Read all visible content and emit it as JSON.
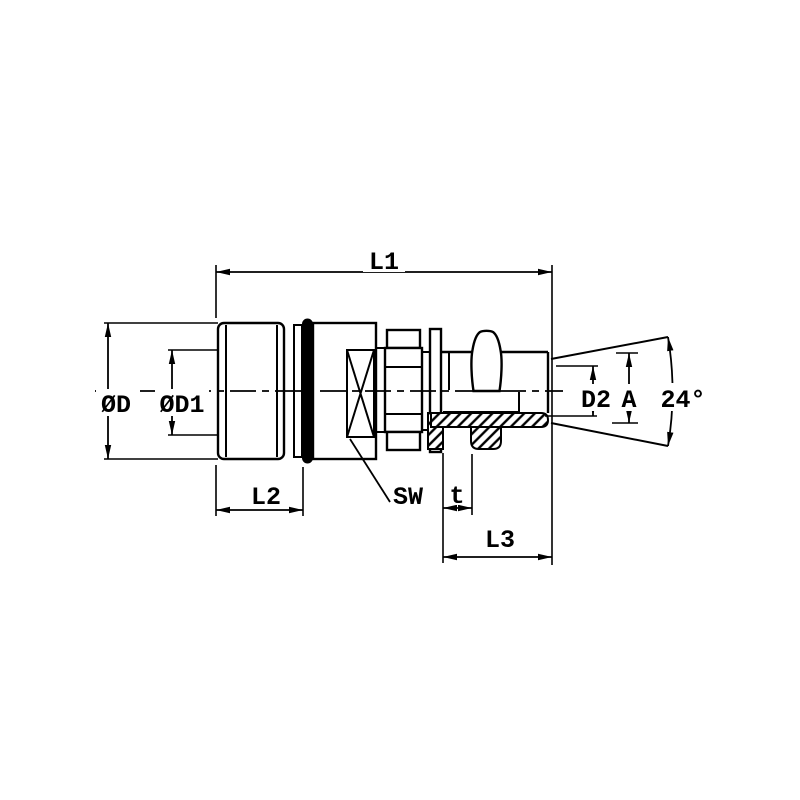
{
  "drawing": {
    "labels": {
      "l1": "L1",
      "od": "ØD",
      "od1": "ØD1",
      "l2": "L2",
      "sw": "SW",
      "t": "t",
      "l3": "L3",
      "d2": "D2",
      "a": "A",
      "cone_angle": "24°"
    },
    "colors": {
      "ink": "#000000",
      "paper": "#ffffff",
      "seal_ring": "#000000"
    }
  }
}
